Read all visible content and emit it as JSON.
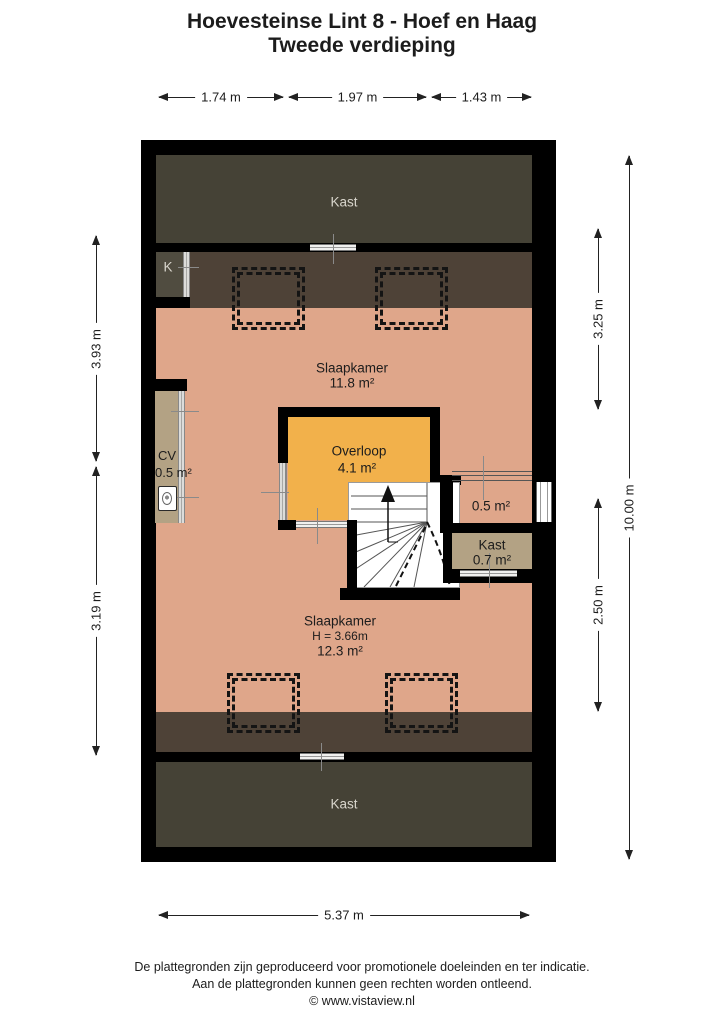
{
  "title": {
    "line1": "Hoevesteinse Lint 8 - Hoef en Haag",
    "line2": "Tweede verdieping"
  },
  "dimensions": {
    "top": [
      {
        "label": "1.74 m"
      },
      {
        "label": "1.97 m"
      },
      {
        "label": "1.43 m"
      }
    ],
    "bottom": {
      "label": "5.37 m"
    },
    "left": [
      {
        "label": "3.93 m"
      },
      {
        "label": "3.19 m"
      }
    ],
    "right": [
      {
        "label": "3.25 m"
      },
      {
        "label": "2.50 m"
      }
    ],
    "right_total": {
      "label": "10.00 m"
    }
  },
  "rooms": {
    "kast_top": {
      "label": "Kast"
    },
    "k_closet": {
      "label": "K"
    },
    "slaapkamer_1": {
      "label": "Slaapkamer",
      "area": "11.8 m²"
    },
    "overloop": {
      "label": "Overloop",
      "area": "4.1 m²"
    },
    "cv": {
      "label": "CV",
      "area": "0.5 m²"
    },
    "void": {
      "area": "0.5 m²"
    },
    "kast_small": {
      "label": "Kast",
      "area": "0.7 m²"
    },
    "slaapkamer_2": {
      "label": "Slaapkamer",
      "height": "H = 3.66m",
      "area": "12.3 m²"
    },
    "kast_bottom": {
      "label": "Kast"
    }
  },
  "footer": {
    "line1": "De plattegronden zijn geproduceerd voor promotionele doeleinden en ter indicatie.",
    "line2": "Aan de plattegronden kunnen geen rechten worden ontleend.",
    "line3": "© www.vistaview.nl"
  },
  "colors": {
    "floor_salmon": "#dfa68a",
    "overloop_orange": "#f2b14b",
    "closet_dark": "#454236",
    "sloped_ceiling_brown": "#4e4237",
    "k_closet_olive": "#504c40",
    "cabinet_tan": "#b3a284",
    "wall_black": "#000000",
    "stairs_white": "#ffffff"
  }
}
